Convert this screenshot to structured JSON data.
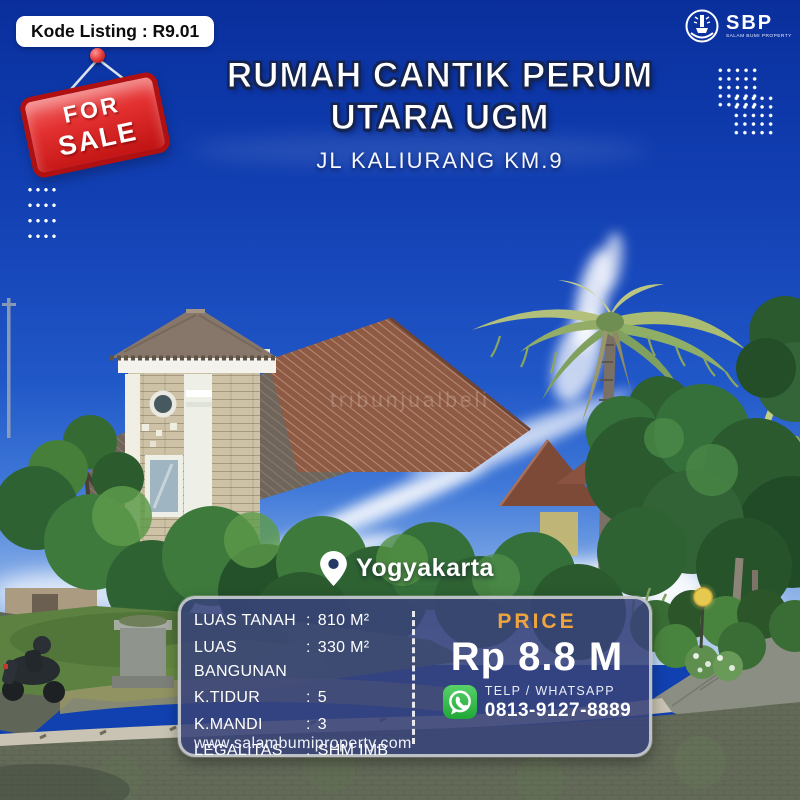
{
  "header": {
    "listing_code": "Kode Listing : R9.01",
    "logo": {
      "abbr": "SBP",
      "caption": "SALAM BUMI PROPERTY"
    }
  },
  "sale_tag": {
    "line1": "FOR",
    "line2": "SALE"
  },
  "title": {
    "line1": "RUMAH CANTIK PERUM",
    "line2": "UTARA UGM",
    "subtitle": "JL KALIURANG KM.9"
  },
  "photo": {
    "location": "Yogyakarta",
    "watermark": "tribunjualbeli"
  },
  "details": {
    "separator": ":",
    "rows": [
      {
        "label": "LUAS TANAH",
        "value": "810 M²"
      },
      {
        "label": "LUAS BANGUNAN",
        "value": "330 M²"
      },
      {
        "label": "K.TIDUR",
        "value": "5"
      },
      {
        "label": "K.MANDI",
        "value": "3"
      },
      {
        "label": "LEGALITAS",
        "value": "SHM IMB"
      }
    ],
    "website": "www.salambumiproperty.com"
  },
  "price": {
    "label": "PRICE",
    "value": "Rp 8.8 M",
    "contact_label": "TELP / WHATSAPP",
    "phone": "0813-9127-8889"
  },
  "colors": {
    "accent_gold": "#F0A43E",
    "whatsapp_green": "#2FBF43",
    "sale_red": "#D61F1F",
    "panel_navy": "#38437A",
    "sky_blue": "#1141B0"
  }
}
